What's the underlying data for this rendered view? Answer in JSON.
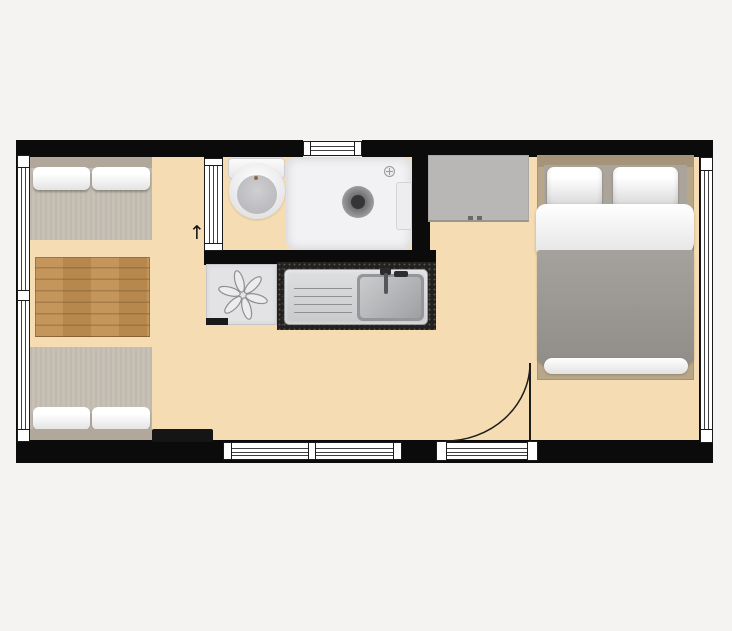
{
  "page": {
    "type": "floor-plan",
    "description": "Top-down floor plan of a small studio cabin with lounge, kitchenette, bathroom and double bed",
    "background_color": "#f4f3f1"
  },
  "annotations": {
    "door_arrow": "↑"
  },
  "colors": {
    "floor": "#f6dcb2",
    "wall": "#0b0b0b",
    "window_glazing": "#ffffff",
    "table_wood": "#c18f52",
    "sofa_fabric": "#c7c0b5",
    "sofa_backrest": "#b1a79a",
    "cushion": "#ffffff",
    "wardrobe": "#b8b7b5",
    "bed_frame": "#b8a689",
    "bed_duvet": "#9c9893",
    "bed_linen": "#f2f2f2",
    "kitchen_counter": "#23211f",
    "sink_steel": "#d5d6d8",
    "shower_tray": "#f2f2f4"
  },
  "elements": {
    "windows": [
      "left-wall-window",
      "top-wall-window",
      "right-wall-window",
      "bottom-wall-window"
    ],
    "doors": [
      "entry-door-swing",
      "bathroom-sliding-door"
    ],
    "furniture": [
      "sofa-top",
      "sofa-bottom",
      "wood-table",
      "doormat",
      "wardrobe",
      "double-bed"
    ],
    "fixtures": [
      "toilet",
      "shower-tray",
      "cooktop-fan-unit",
      "kitchen-counter",
      "kitchen-sink",
      "faucet"
    ]
  }
}
